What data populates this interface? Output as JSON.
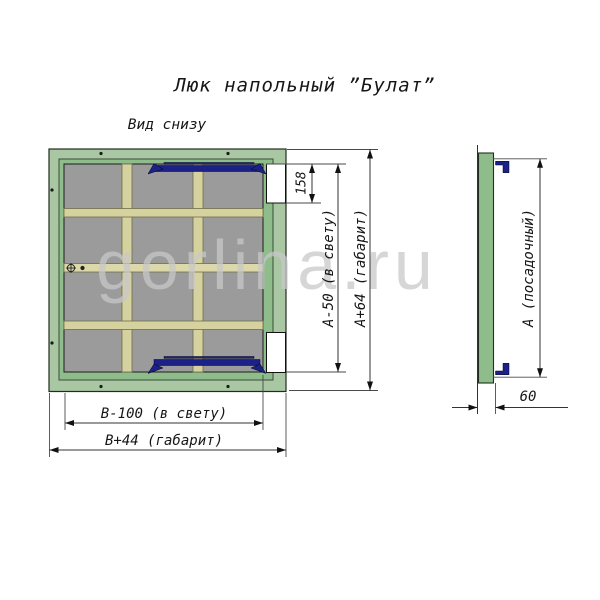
{
  "title": "Люк напольный ”Булат”",
  "watermark": "gorlina.ru",
  "plan_view": {
    "label": "Вид снизу",
    "dims": {
      "hinge_offset": "158",
      "inner_height": "А-50 (в свету)",
      "outer_height": "А+64 (габарит)",
      "inner_width": "В-100 (в свету)",
      "outer_width": "В+44 (габарит)"
    }
  },
  "side_view": {
    "dims": {
      "seat_height": "А (посадочный)",
      "thickness": "60"
    }
  },
  "colors": {
    "frame_green": "#a8c7a2",
    "lid_green": "#8ebc8b",
    "panel_gray": "#9b9b9b",
    "stringer_beige": "#d6d2a0",
    "stringer_middle": "#dcd8aa",
    "hinge_navy": "#1c2285",
    "line_dark": "#333333",
    "watermark_gray": "#c8c8c8"
  }
}
